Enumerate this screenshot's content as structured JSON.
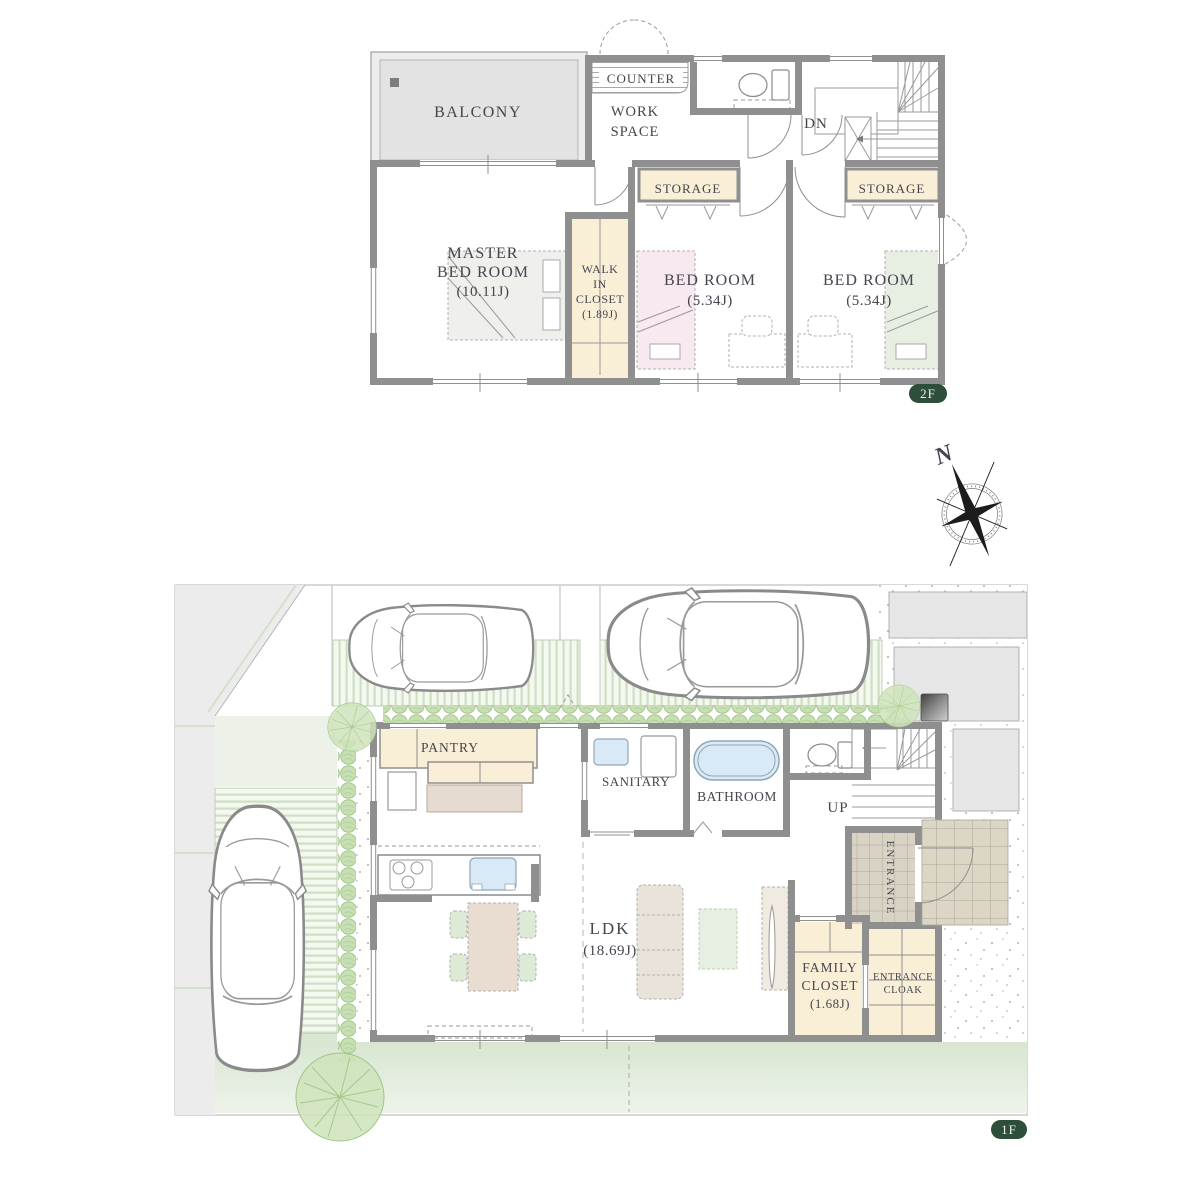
{
  "compass": {
    "north": "N"
  },
  "floor2": {
    "badge": "2F",
    "balcony": "BALCONY",
    "counter": "COUNTER",
    "workspace_l1": "WORK",
    "workspace_l2": "SPACE",
    "dn": "DN",
    "storage_left": "STORAGE",
    "storage_right": "STORAGE",
    "master_l1": "MASTER",
    "master_l2": "BED ROOM",
    "master_l3": "(10.11J)",
    "wic_l1": "WALK",
    "wic_l2": "IN",
    "wic_l3": "CLOSET",
    "wic_l4": "(1.89J)",
    "bedroom1_l1": "BED ROOM",
    "bedroom1_l2": "(5.34J)",
    "bedroom2_l1": "BED ROOM",
    "bedroom2_l2": "(5.34J)"
  },
  "floor1": {
    "badge": "1F",
    "pantry": "PANTRY",
    "sanitary": "SANITARY",
    "bathroom": "BATHROOM",
    "up": "UP",
    "entrance": "ENTRANCE",
    "ldk_l1": "LDK",
    "ldk_l2": "(18.69J)",
    "family_closet_l1": "FAMILY",
    "family_closet_l2": "CLOSET",
    "family_closet_l3": "(1.68J)",
    "entrance_cloak_l1": "ENTRANCE",
    "entrance_cloak_l2": "CLOAK"
  },
  "colors": {
    "wall": "#8f8f8f",
    "cream": "#f9efd7",
    "bed_pink": "#f8e8ef",
    "bed_green": "#e7efe2",
    "fixture_blue": "#d9eaf6",
    "lawn": "#dfeada",
    "hedge": "#c8dfb4",
    "tile": "#dcd6c6",
    "badge": "#2d4e3b",
    "text": "#45454f"
  }
}
